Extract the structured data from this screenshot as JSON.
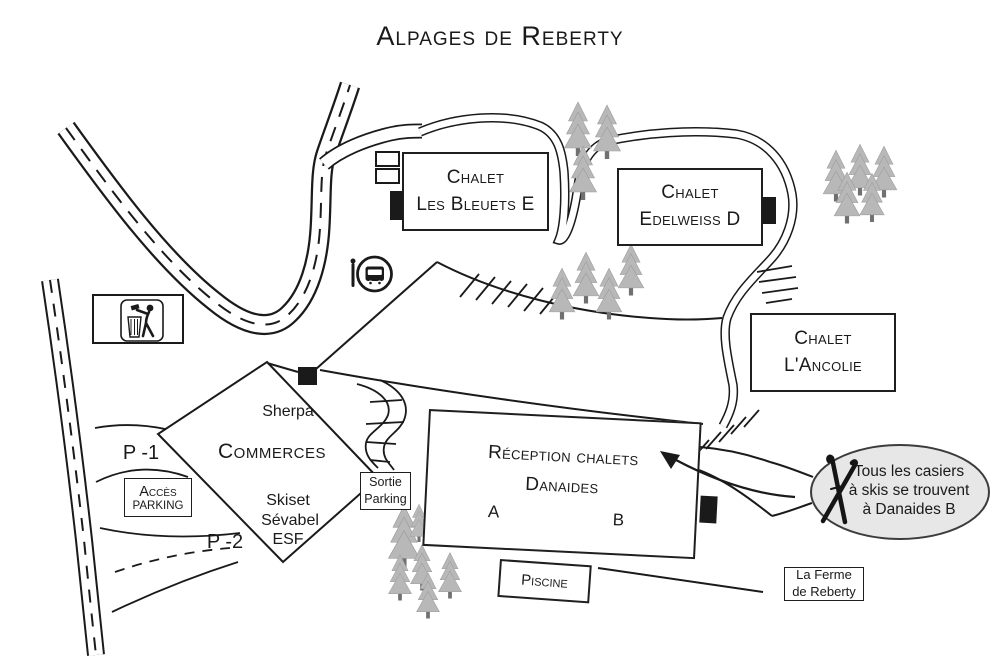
{
  "title": "Alpages de Reberty",
  "chalets": {
    "bleuets_line1": "Chalet",
    "bleuets_line2": "Les Bleuets E",
    "edelweiss_line1": "Chalet",
    "edelweiss_line2": "Edelweiss D",
    "ancolie_line1": "Chalet",
    "ancolie_line2": "L'Ancolie"
  },
  "reception": {
    "line1": "Réception chalets",
    "line2": "Danaides",
    "wing_a": "A",
    "wing_b": "B"
  },
  "commerces": {
    "name": "Commerces",
    "shop_sherpa": "Sherpa",
    "shop_skiset": "Skiset",
    "shop_sevabel": "Sévabel",
    "shop_esf": "ESF"
  },
  "parking": {
    "access_line1": "Accès",
    "access_line2": "PARKING",
    "exit_line1": "Sortie",
    "exit_line2": "Parking",
    "level1": "P -1",
    "level2": "P -2"
  },
  "pool_label": "Piscine",
  "farm": {
    "line1": "La Ferme",
    "line2": "de Reberty"
  },
  "ski_note": {
    "line1": "Tous les casiers",
    "line2": "à skis se trouvent",
    "line3": "à Danaides B"
  },
  "icons": [
    "bus-stop-icon",
    "litter-icon",
    "crossed-skis-icon"
  ],
  "colors": {
    "ink": "#1a1a1a",
    "tree_fill": "#b8b8b8",
    "tree_trunk": "#707070",
    "note_bubble_fill": "#e7e7e7"
  }
}
